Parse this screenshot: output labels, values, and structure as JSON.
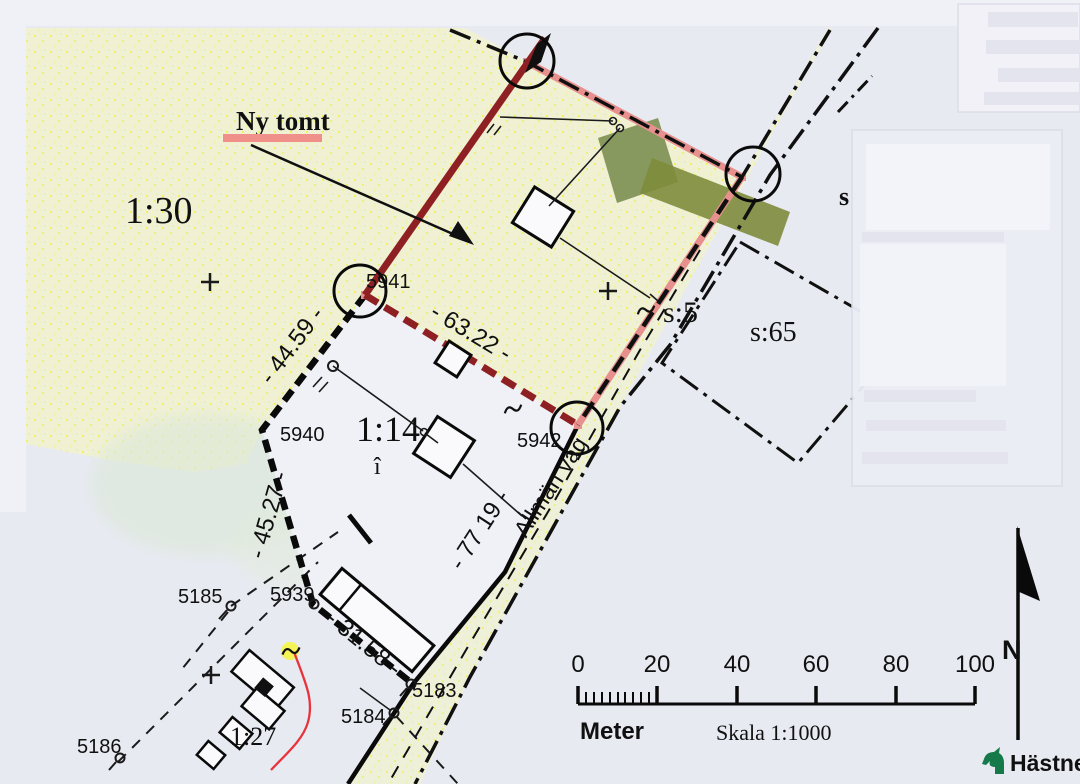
{
  "annotation": {
    "label": "Ny tomt"
  },
  "parcel_labels": {
    "forest": "1:30",
    "farm": "1:14",
    "farm_sub": "î",
    "south": "1:27",
    "s5": "s:5",
    "s65": "s:65",
    "s_partial": "s"
  },
  "survey_points": {
    "p5941": "5941",
    "p5940": "5940",
    "p5942": "5942",
    "p5939": "5939",
    "p5185": "5185",
    "p5186": "5186",
    "p5184": "5184",
    "p5183": "5183"
  },
  "measurements": {
    "nw": "- 44.59 -",
    "ne": "- 63.22 -",
    "w": "- 45.27 -",
    "road": "- 77 19 -",
    "s": "- 31.58 -"
  },
  "road": {
    "name": "Allmän väg"
  },
  "scale_bar": {
    "tick_labels": [
      "0",
      "20",
      "40",
      "60",
      "80",
      "100"
    ],
    "unit": "Meter",
    "scale_text": "Skala 1:1000"
  },
  "compass": {
    "north": "N"
  },
  "logo": {
    "brand": "Hästnet"
  },
  "colors": {
    "paper": "#e8eaf2",
    "land_yellow": "#f0f1d3",
    "plot_dark_red": "#8e2024",
    "plot_pink": "#e8908e",
    "ny_tomt_underline": "#f0908a",
    "green_main": "#7e9155",
    "green_arm": "#7e8c3c",
    "red_path": "#e8333c",
    "logo_green": "#15794a"
  }
}
